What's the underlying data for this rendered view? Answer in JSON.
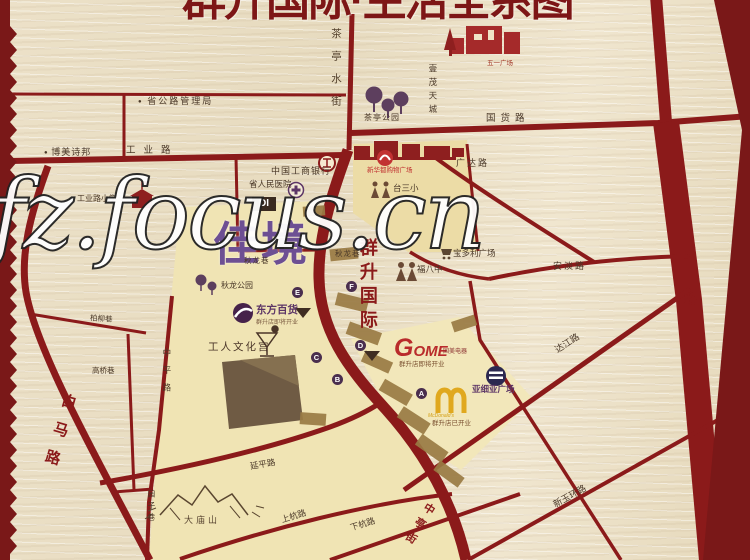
{
  "title": "群升国际·生活全系图",
  "watermark": "fz.focus.cn",
  "project": {
    "name_vertical": "群升国际",
    "block_name": "佳境",
    "block_badge": "DI"
  },
  "labels": {
    "shenggonglu_admin": "省公路管理局",
    "bomeishibang": "博美诗邦",
    "gongyelu": "工业路",
    "gongyelu_school": "工业路小学",
    "chating_shuijie": "茶亭水街",
    "chating_park": "茶亭公园",
    "yimao_tiancheng": "壹茂天城",
    "wuyi_square": "五一广场",
    "guohuolu": "国货路",
    "guangdalu": "广达路",
    "taisanxiao": "台三小",
    "xinhuadu": "新华都购物广场",
    "icbc": "中国工商银行",
    "hospital": "省人民医院",
    "qiulongxiang_w": "秋龙巷",
    "qiulongxiang_e": "秋龙巷",
    "qiulong_park": "秋龙公园",
    "fubazhong": "福八中",
    "baoduoli": "宝多利广场",
    "andanlu": "安淡路",
    "wuyilu": "五一路",
    "dajianglu": "达江路",
    "xinyuhuanlu": "新玉环路",
    "dongfang_baihuo": "东方百货",
    "dongfang_sub": "群升店即将开业",
    "wenhuagong": "工人文化宫",
    "damiaoshan": "大庙山",
    "baimalu": "白马路",
    "zhongpinglu": "中平路",
    "yuanzixiang": "园子巷",
    "gaoqiaoxiang": "高桥巷",
    "bailiuxiang": "柏柳巷",
    "yanpinglu": "延平路",
    "shanghanglu": "上杭路",
    "xiahanglu": "下杭路",
    "zhongtingjie": "中亭街",
    "gome": "GOME",
    "gome_cn": "国美电器",
    "gome_sub": "群升店即将开业",
    "mcd": "McDonald's",
    "mcd_sub": "群升店已开业",
    "yaxiya": "亚细亚广场"
  },
  "markers": {
    "a": "A",
    "b": "B",
    "c": "C",
    "d": "D",
    "e": "E",
    "f": "F"
  },
  "colors": {
    "road": "#8b1a1a",
    "border": "#7a1818",
    "zone_yellow": "#f0e4b4",
    "brand_purple": "#5c3566",
    "gold": "#d4a017"
  }
}
